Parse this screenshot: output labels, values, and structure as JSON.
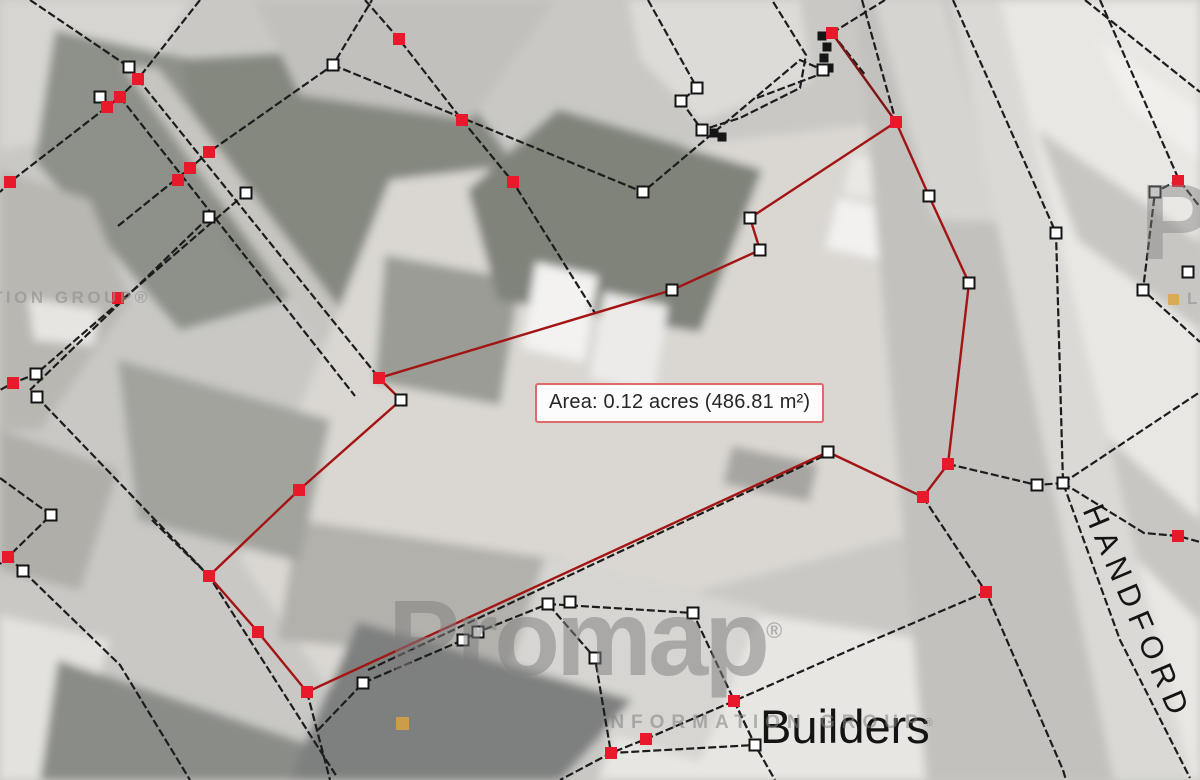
{
  "map": {
    "area_label": "Area: 0.12 acres (486.81 m²)",
    "street_label": "HANDFORD",
    "poi_label": "Builders",
    "watermark": {
      "brand": "Promap",
      "brand_mark": "®",
      "tagline": "LANDMARK INFORMATION GROUP",
      "tagline_mark": "®",
      "tile_left_fragment": "TION GROUP®",
      "tile_right_brand_fragment": "Pr",
      "tile_right_tagline_fragment": "LAN",
      "bullet_color": "#dfa23c"
    },
    "colors": {
      "base_ground": "#c9c8c5",
      "boundary_black": "#1c1c1c",
      "boundary_red": "#a31515",
      "spur_red": "#7d1616",
      "vertex_red": "#e8192b",
      "vertex_white_fill": "#ffffff",
      "vertex_white_stroke": "#141414",
      "label_border_red": "#e06a6a"
    },
    "geometry": {
      "patches": [
        {
          "fill": "#d7d5d1",
          "points": [
            0,
            0,
            190,
            0,
            120,
            130,
            0,
            150
          ]
        },
        {
          "fill": "#8d9189",
          "points": [
            55,
            30,
            330,
            90,
            420,
            260,
            180,
            330,
            35,
            160
          ]
        },
        {
          "fill": "#84887f",
          "points": [
            180,
            60,
            430,
            45,
            560,
            230,
            400,
            360,
            230,
            250
          ]
        },
        {
          "fill": "#c7c5c0",
          "points": [
            122,
            65,
            158,
            68,
            400,
            388,
            362,
            398
          ]
        },
        {
          "fill": "#b9b7b1",
          "points": [
            0,
            170,
            90,
            200,
            130,
            300,
            40,
            430,
            0,
            430
          ]
        },
        {
          "fill": "#e6e5e2",
          "points": [
            28,
            298,
            100,
            310,
            94,
            346,
            34,
            340
          ]
        },
        {
          "fill": "#c2c0bd",
          "points": [
            255,
            0,
            555,
            0,
            470,
            120,
            300,
            95
          ]
        },
        {
          "fill": "#dddbd7",
          "points": [
            628,
            0,
            800,
            0,
            812,
            80,
            700,
            122,
            640,
            58
          ]
        },
        {
          "fill": "#dad7d2",
          "points": [
            390,
            180,
            900,
            120,
            965,
            520,
            330,
            690,
            240,
            560
          ]
        },
        {
          "fill": "#9a9c95",
          "points": [
            385,
            255,
            520,
            280,
            500,
            405,
            375,
            382
          ]
        },
        {
          "fill": "#7f8379",
          "points": [
            558,
            110,
            762,
            170,
            700,
            332,
            498,
            300,
            468,
            190
          ]
        },
        {
          "fill": "#b3b1ac",
          "points": [
            298,
            520,
            560,
            560,
            520,
            662,
            278,
            640
          ]
        },
        {
          "fill": "#f3f2f0",
          "points": [
            536,
            262,
            598,
            276,
            584,
            362,
            522,
            348
          ]
        },
        {
          "fill": "#ecebe9",
          "points": [
            604,
            292,
            668,
            306,
            654,
            392,
            590,
            378
          ]
        },
        {
          "fill": "#f2f1ef",
          "points": [
            838,
            198,
            902,
            212,
            890,
            262,
            826,
            248
          ]
        },
        {
          "fill": "#e9e8e5",
          "points": [
            852,
            154,
            912,
            167,
            903,
            206,
            843,
            193
          ]
        },
        {
          "fill": "#a7a5a1",
          "points": [
            732,
            446,
            818,
            464,
            809,
            502,
            723,
            484
          ]
        },
        {
          "fill": "#e9e7e3",
          "points": [
            990,
            0,
            1200,
            0,
            1200,
            780,
            1180,
            780,
            995,
            130
          ]
        },
        {
          "fill": "#f1efec",
          "points": [
            1098,
            40,
            1200,
            110,
            1200,
            162,
            1128,
            105
          ]
        },
        {
          "fill": "#c8c6c3",
          "points": [
            1038,
            130,
            1200,
            242,
            1200,
            330,
            1078,
            240
          ]
        },
        {
          "fill": "#c8c6c3",
          "points": [
            1088,
            420,
            1200,
            520,
            1200,
            622,
            1138,
            560
          ]
        },
        {
          "fill": "#e8e6e2",
          "points": [
            658,
            598,
            930,
            640,
            1062,
            780,
            598,
            780
          ]
        },
        {
          "fill": "#c2c1be",
          "points": [
            856,
            0,
            952,
            0,
            1122,
            780,
            926,
            780
          ]
        },
        {
          "fill": "#d6d4d0",
          "points": [
            874,
            0,
            944,
            0,
            1000,
            222,
            934,
            220
          ]
        },
        {
          "fill": "#dbd9d5",
          "points": [
            950,
            0,
            1000,
            0,
            1192,
            780,
            1114,
            780
          ]
        },
        {
          "fill": "#a3a39e",
          "points": [
            118,
            360,
            330,
            420,
            300,
            562,
            138,
            520
          ]
        },
        {
          "fill": "#b0aea8",
          "points": [
            0,
            430,
            118,
            470,
            80,
            590,
            0,
            570
          ]
        },
        {
          "fill": "#e4e2de",
          "points": [
            0,
            615,
            110,
            640,
            68,
            780,
            0,
            780
          ]
        },
        {
          "fill": "#8a8c88",
          "points": [
            58,
            660,
            330,
            752,
            300,
            780,
            40,
            780
          ]
        },
        {
          "fill": "#d7d5d1",
          "points": [
            545,
            558,
            762,
            608,
            700,
            762,
            498,
            700
          ]
        },
        {
          "fill": "#7d807e",
          "points": [
            358,
            622,
            632,
            700,
            560,
            780,
            290,
            780
          ]
        }
      ],
      "black_lines": [
        [
          200,
          0,
          138,
          79,
          120,
          97,
          107,
          107,
          10,
          182,
          0,
          192
        ],
        [
          30,
          0,
          129,
          67,
          138,
          79
        ],
        [
          138,
          79,
          379,
          378
        ],
        [
          120,
          97,
          355,
          396
        ],
        [
          118,
          226,
          190,
          168,
          209,
          152,
          333,
          65,
          372,
          0
        ],
        [
          246,
          193,
          36,
          374,
          13,
          383,
          0,
          390
        ],
        [
          209,
          217,
          30,
          390
        ],
        [
          37,
          397,
          209,
          576
        ],
        [
          0,
          478,
          51,
          515,
          8,
          557,
          0,
          564
        ],
        [
          8,
          557,
          23,
          571,
          120,
          665,
          190,
          780
        ],
        [
          152,
          520,
          209,
          576,
          337,
          777
        ],
        [
          307,
          692,
          330,
          780
        ],
        [
          318,
          730,
          363,
          683,
          463,
          640,
          478,
          632,
          548,
          604
        ],
        [
          368,
          670,
          826,
          455
        ],
        [
          548,
          604,
          693,
          613,
          755,
          745,
          611,
          753,
          595,
          658,
          548,
          604
        ],
        [
          986,
          592,
          850,
          650,
          734,
          701,
          646,
          739,
          611,
          753,
          560,
          780
        ],
        [
          734,
          701,
          755,
          745,
          775,
          780
        ],
        [
          923,
          497,
          986,
          592,
          1063,
          770,
          1066,
          780
        ],
        [
          862,
          0,
          896,
          122
        ],
        [
          953,
          0,
          1056,
          233,
          1063,
          483,
          1120,
          640,
          1190,
          778
        ],
        [
          948,
          464,
          1037,
          485,
          1063,
          483
        ],
        [
          1063,
          483,
          1144,
          533,
          1178,
          536,
          1200,
          542
        ],
        [
          1063,
          483,
          1200,
          392
        ],
        [
          1100,
          0,
          1179,
          180,
          1200,
          207
        ],
        [
          1179,
          180,
          1155,
          192,
          1143,
          290,
          1200,
          342
        ],
        [
          1085,
          0,
          1200,
          92
        ],
        [
          333,
          65,
          643,
          192,
          800,
          60,
          823,
          70
        ],
        [
          648,
          0,
          697,
          88,
          681,
          101,
          702,
          130,
          740,
          118,
          800,
          88,
          806,
          55,
          772,
          0
        ],
        [
          832,
          33,
          885,
          0
        ],
        [
          832,
          33,
          866,
          76
        ],
        [
          826,
          72,
          757,
          98
        ],
        [
          365,
          0,
          399,
          39,
          462,
          120,
          513,
          182,
          595,
          313
        ]
      ],
      "red_polygon": [
        896,
        122,
        929,
        196,
        969,
        283,
        948,
        464,
        923,
        497,
        828,
        452,
        307,
        692,
        258,
        632,
        209,
        576,
        299,
        490,
        401,
        400,
        379,
        378,
        672,
        290,
        760,
        250,
        750,
        218
      ],
      "red_spur": [
        832,
        33,
        896,
        122
      ],
      "white_vertices": [
        [
          129,
          67
        ],
        [
          100,
          97
        ],
        [
          246,
          193
        ],
        [
          209,
          217
        ],
        [
          36,
          374
        ],
        [
          37,
          397
        ],
        [
          51,
          515
        ],
        [
          23,
          571
        ],
        [
          333,
          65
        ],
        [
          643,
          192
        ],
        [
          697,
          88
        ],
        [
          681,
          101
        ],
        [
          702,
          130
        ],
        [
          823,
          70
        ],
        [
          750,
          218
        ],
        [
          760,
          250
        ],
        [
          672,
          290
        ],
        [
          401,
          400
        ],
        [
          828,
          452
        ],
        [
          929,
          196
        ],
        [
          969,
          283
        ],
        [
          1037,
          485
        ],
        [
          1056,
          233
        ],
        [
          1063,
          483
        ],
        [
          1155,
          192
        ],
        [
          1143,
          290
        ],
        [
          1188,
          272
        ],
        [
          548,
          604
        ],
        [
          570,
          602
        ],
        [
          693,
          613
        ],
        [
          595,
          658
        ],
        [
          755,
          745
        ],
        [
          463,
          640
        ],
        [
          478,
          632
        ],
        [
          363,
          683
        ]
      ],
      "red_vertices": [
        [
          896,
          122
        ],
        [
          948,
          464
        ],
        [
          923,
          497
        ],
        [
          986,
          592
        ],
        [
          379,
          378
        ],
        [
          299,
          490
        ],
        [
          209,
          576
        ],
        [
          258,
          632
        ],
        [
          307,
          692
        ],
        [
          832,
          33
        ],
        [
          138,
          79
        ],
        [
          120,
          97
        ],
        [
          107,
          107
        ],
        [
          209,
          152
        ],
        [
          190,
          168
        ],
        [
          178,
          180
        ],
        [
          10,
          182
        ],
        [
          13,
          383
        ],
        [
          8,
          557
        ],
        [
          118,
          298
        ],
        [
          399,
          39
        ],
        [
          462,
          120
        ],
        [
          513,
          182
        ],
        [
          734,
          701
        ],
        [
          646,
          739
        ],
        [
          611,
          753
        ],
        [
          1178,
          181
        ],
        [
          1178,
          536
        ]
      ],
      "black_marks": [
        [
          822,
          36
        ],
        [
          827,
          47
        ],
        [
          824,
          58
        ],
        [
          829,
          68
        ],
        [
          714,
          133
        ],
        [
          722,
          137
        ]
      ]
    }
  }
}
